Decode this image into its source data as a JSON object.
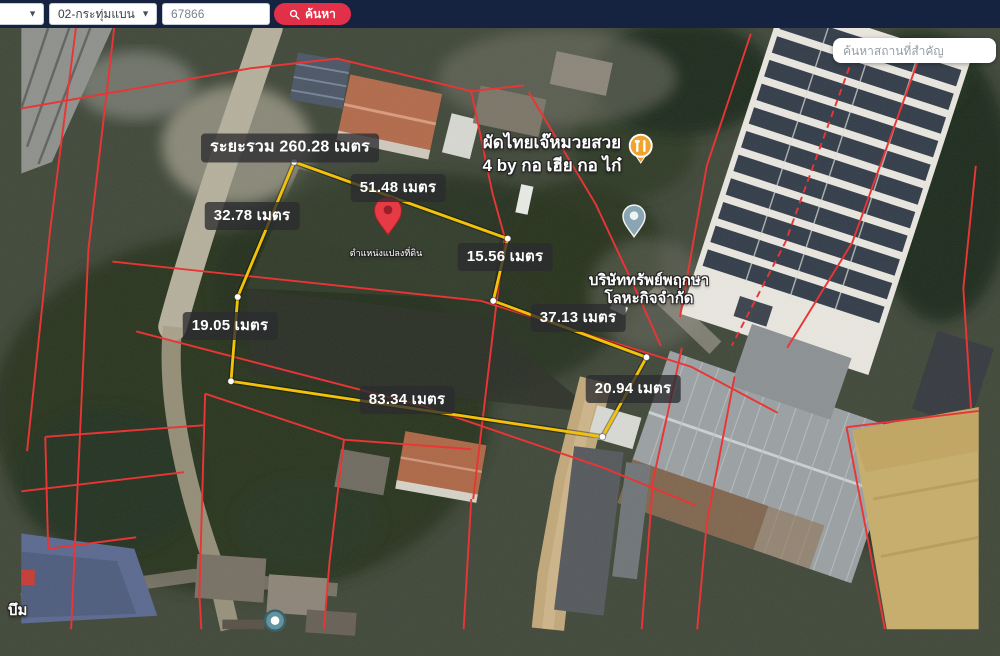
{
  "topbar": {
    "province_select": {
      "value": ""
    },
    "district_select": {
      "value": "02-กระทุ่มแบน"
    },
    "parcel_input": {
      "value": "67866"
    },
    "search_button": {
      "label": "ค้นหา"
    }
  },
  "map_search": {
    "placeholder": "ค้นหาสถานที่สำคัญ"
  },
  "parcel": {
    "total_distance_label": "ระยะรวม 260.28 เมตร",
    "measurements": [
      {
        "edge": "top",
        "text": "51.48 เมตร"
      },
      {
        "edge": "upper-left",
        "text": "32.78 เมตร"
      },
      {
        "edge": "right-upper",
        "text": "15.56 เมตร"
      },
      {
        "edge": "left",
        "text": "19.05 เมตร"
      },
      {
        "edge": "right-mid",
        "text": "37.13 เมตร"
      },
      {
        "edge": "bottom",
        "text": "83.34 เมตร"
      },
      {
        "edge": "right-lower",
        "text": "20.94 เมตร"
      }
    ],
    "pin_label": "ตำแหน่งแปลงที่ดิน"
  },
  "pois": {
    "restaurant": {
      "line1": "ผัดไทยเจ๊หมวยสวย",
      "line2": "4 by กอ เฮีย กอ ไก๋"
    },
    "company": {
      "line1": "บริษัททรัพย์พฤกษา",
      "line2": "โลหะกิจจำกัด"
    },
    "village": {
      "label": "บึม"
    }
  },
  "colors": {
    "boundary_yellow": "#f2c20a",
    "cadastral_red": "#e93535",
    "button_red": "#e23049",
    "topbar_navy": "#152340"
  }
}
